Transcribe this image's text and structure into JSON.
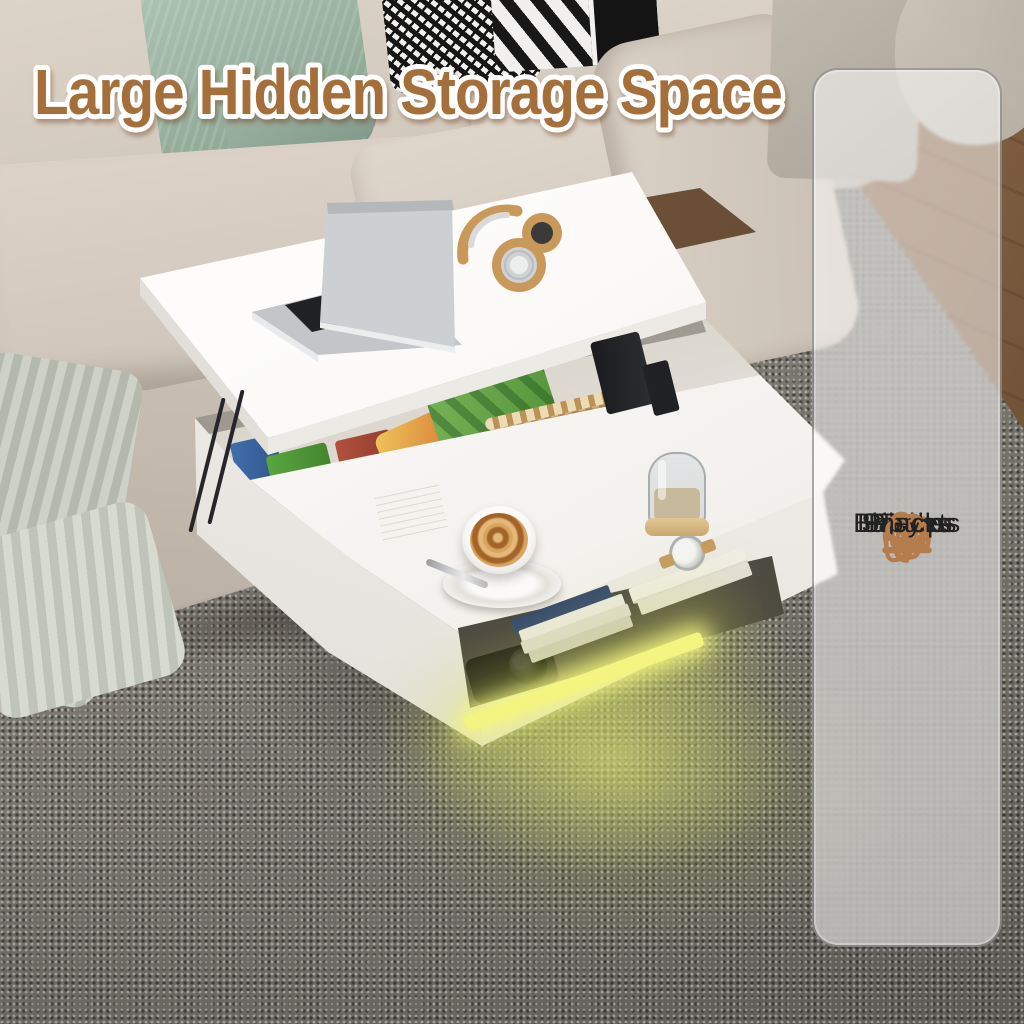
{
  "title": {
    "text": "Large Hidden Storage Space",
    "text_color": "#a56f3b",
    "outline_color": "#ffffff"
  },
  "sidebar": {
    "background": "rgba(255,255,255,0.52)",
    "accent_color": "#b57c4e",
    "label_color": "#222222",
    "items": [
      {
        "label": "Pillows",
        "icon": "pillows-icon"
      },
      {
        "label": "Blankets",
        "icon": "blankets-icon"
      },
      {
        "label": "Books",
        "icon": "books-icon"
      },
      {
        "label": "Toys",
        "icon": "toys-icon"
      },
      {
        "label": "Laptops",
        "icon": "laptops-icon"
      },
      {
        "label": "Snacks",
        "icon": "snacks-icon"
      }
    ]
  },
  "scene": {
    "type": "product-photo",
    "product": "white lift-top coffee table with hidden storage compartment and LED strip light",
    "led_color": "#f4f480",
    "objects": [
      "beige-sofa",
      "sage-green-pillow",
      "houndstooth-pillow",
      "striped-pillow",
      "knit-blanket",
      "gray-woven-rug",
      "wood-floor",
      "silver-laptop",
      "tan-headphones",
      "snack-boxes",
      "chips-bags",
      "canned-drink",
      "woven-storage-basket",
      "books",
      "glass-jar",
      "latte-coffee-cup",
      "camera",
      "wrist-watch",
      "led-strip-light"
    ]
  }
}
